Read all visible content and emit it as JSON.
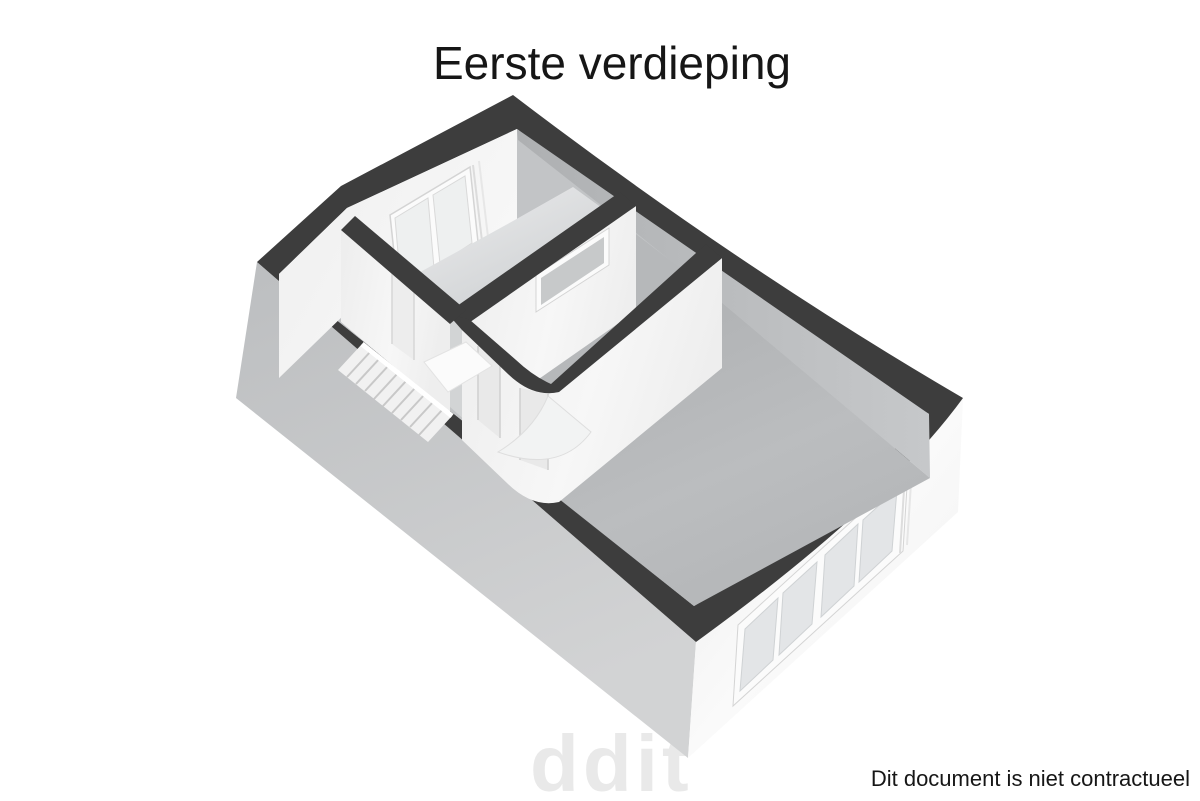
{
  "title": "Eerste verdieping",
  "footer": {
    "disclaimer": "Dit document is niet contractueel"
  },
  "watermark": {
    "text": "ddit"
  },
  "colors": {
    "background": "#ffffff",
    "text": "#161616",
    "watermark": "#e9e9e9",
    "wall_top": "#3d3d3d",
    "facade_shadow": "#c4c6c7",
    "facade_light": "#f7f7f7",
    "floor_base": "#c2c4c6",
    "floor_room_light": "#e7e8e9",
    "floor_room_mid": "#b6b8ba",
    "face_white": "#f4f4f4",
    "face_shadow": "#b9bbbd",
    "glass": "#e3e5e7",
    "frame_white": "#fbfbfb",
    "frame_line": "#d4d4d4",
    "stair_tread": "#f1f1f1",
    "stair_line": "#c8c8c8",
    "landing": "#fbfbfb",
    "door_opening": "#e9e9e9"
  },
  "floor_plan": {
    "view": "3d-isometric-floorplan",
    "floor_label": "Eerste verdieping",
    "features": {
      "rooms_visible": 4,
      "staircase": true,
      "double_window_nw_wall": true,
      "interior_slit_window": true,
      "se_facade_window_panes": 4,
      "door_openings": 3
    }
  }
}
